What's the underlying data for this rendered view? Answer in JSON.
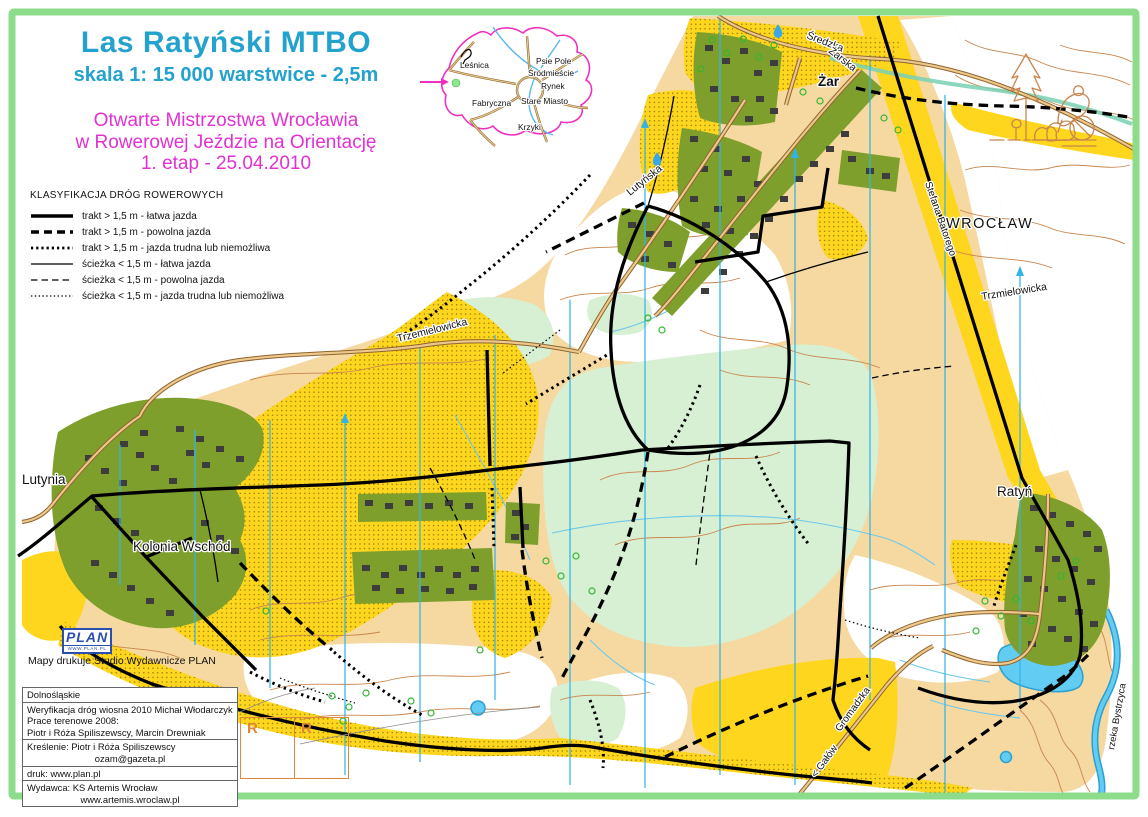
{
  "colors": {
    "frame": "#8cdc8c",
    "title_text": "#23a2cd",
    "event_text": "#e231d2",
    "open_yellow": "#ffd61e",
    "open_tan": "#f5d9a1",
    "forest_green": "#d7efd3",
    "settlement_olive": "#7f9f2c",
    "water_blue": "#62ccf2",
    "contour_brown": "#c9854d",
    "north_line_cyan": "#30b4e8",
    "city_boundary_magenta": "#f030c0",
    "registration_orange": "#e0873a"
  },
  "header": {
    "title": "Las Ratyński MTBO",
    "scale_line": "skala 1: 15 000  warstwice - 2,5m",
    "event_line1": "Otwarte Mistrzostwa Wrocławia",
    "event_line2": "w Rowerowej Jeździe na Orientację",
    "event_line3": "1. etap - 25.04.2010"
  },
  "legend": {
    "heading": "KLASYFIKACJA DRÓG ROWEROWYCH",
    "items": [
      {
        "label": "trakt > 1,5 m - łatwa jazda",
        "style": "thick-solid"
      },
      {
        "label": "trakt > 1,5 m - powolna jazda",
        "style": "thick-dashed"
      },
      {
        "label": "trakt > 1,5 m - jazda trudna lub niemożliwa",
        "style": "thick-dotted"
      },
      {
        "label": "ścieżka < 1,5 m - łatwa jazda",
        "style": "thin-solid"
      },
      {
        "label": "ścieżka < 1,5 m - powolna jazda",
        "style": "thin-dashed"
      },
      {
        "label": "ścieżka < 1,5 m - jazda trudna lub niemożliwa",
        "style": "thin-dotted"
      }
    ]
  },
  "inset": {
    "lesnica": "Leśnica",
    "psie_pole": "Psie Pole",
    "srodmiescie": "Śródmieście",
    "rynek": "Rynek",
    "fabryczna": "Fabryczna",
    "stare_miasto": "Stare Miasto",
    "krzyki": "Krzyki"
  },
  "map_labels": {
    "zar": "Żar",
    "wroclaw": "WROCŁAW",
    "lutynia": "Lutynia",
    "kolonia_wschod": "Kolonia Wschód",
    "ratyn": "Ratyń",
    "sredzka": "Średzka",
    "zarska": "Żarska",
    "lutynska": "Lutyńska",
    "stefana_batorego": "Stefana Batorego",
    "trzmielowicka_east": "Trzmielowicka",
    "trzemielowicka_west": "Trzemielowicka",
    "gromadzka": "Gromadzka",
    "galow": "< Gałów",
    "rzeka_bystrzyca": "rzeka Bystrzyca"
  },
  "footer": {
    "print_note": "Mapy drukuje Studio Wydawnicze PLAN",
    "plan_logo": "PLAN",
    "plan_logo_sub": "WWW.PLAN.PL",
    "marks": [
      "R",
      "R"
    ],
    "credits": [
      "Dolnośląskie",
      "Weryfikacja dróg wiosna 2010 Michał Włodarczyk",
      "Prace terenowe 2008:",
      "Piotr i Róża Spiliszewscy, Marcin Drewniak",
      "Kreślenie: Piotr i Róża Spiliszewscy",
      "ozam@gazeta.pl",
      "druk: www.plan.pl",
      "Wydawca: KS Artemis Wrocław",
      "www.artemis.wroclaw.pl"
    ]
  }
}
